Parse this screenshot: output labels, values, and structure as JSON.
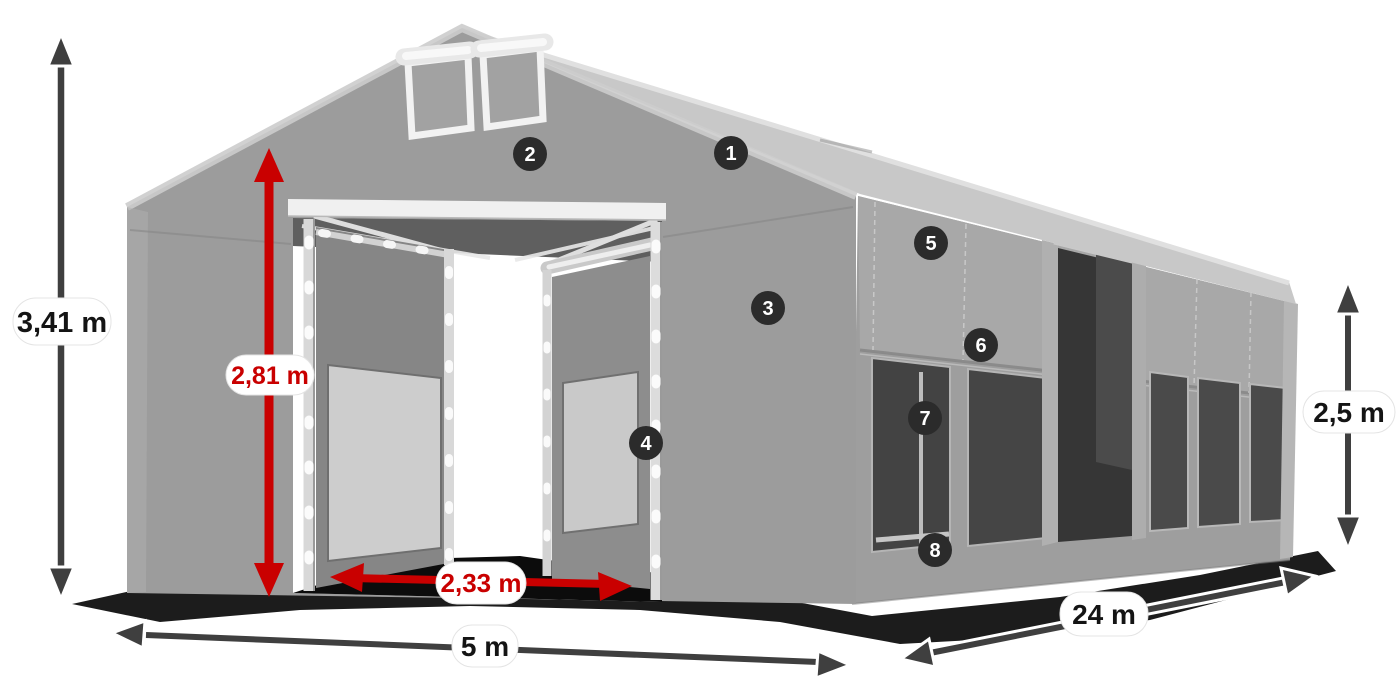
{
  "diagram": {
    "dimensions": {
      "total_height": "3,41 m",
      "entrance_height": "2,81 m",
      "entrance_width": "2,33 m",
      "front_width": "5 m",
      "side_length": "24 m",
      "side_wall_height": "2,5 m"
    },
    "callouts": [
      {
        "number": "1"
      },
      {
        "number": "2"
      },
      {
        "number": "3"
      },
      {
        "number": "4"
      },
      {
        "number": "5"
      },
      {
        "number": "6"
      },
      {
        "number": "7"
      },
      {
        "number": "8"
      }
    ],
    "colors": {
      "accent_red": "#c90000",
      "arrow_dark": "#3f3f3f",
      "badge_background": "#2b2b2b",
      "badge_text": "#ffffff",
      "label_background": "#ffffff",
      "tent_fabric_gray": "#9c9c9c",
      "window_dark_gray": "#474747",
      "ground_shadow": "#0b0b0b",
      "page_background": "#ffffff"
    }
  }
}
